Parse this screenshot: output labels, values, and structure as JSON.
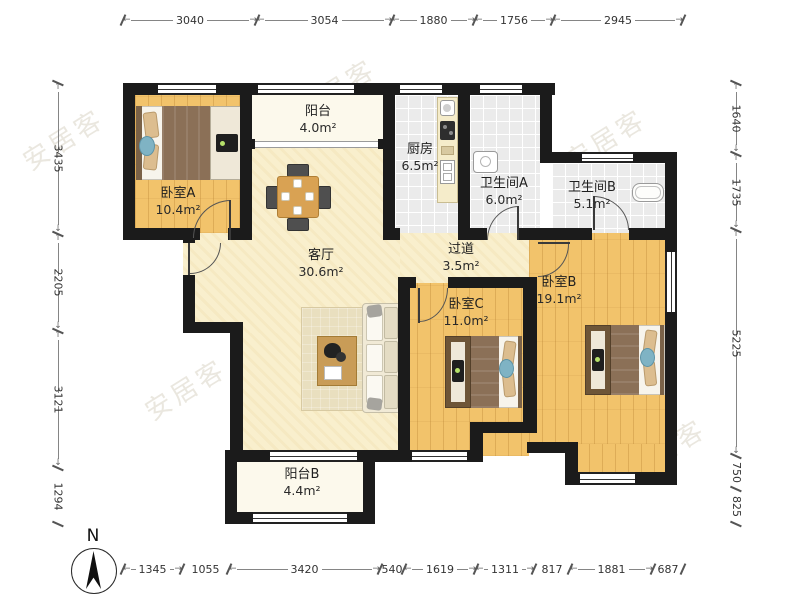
{
  "title": "三室两厅户型图",
  "compass": {
    "label": "N"
  },
  "watermark": {
    "text": "安居客"
  },
  "rooms": [
    {
      "id": "bedroomA",
      "name": "卧室A",
      "area": "10.4m²"
    },
    {
      "id": "balconyA",
      "name": "阳台",
      "area": "4.0m²"
    },
    {
      "id": "kitchen",
      "name": "厨房",
      "area": "6.5m²"
    },
    {
      "id": "bathA",
      "name": "卫生间A",
      "area": "6.0m²"
    },
    {
      "id": "bathB",
      "name": "卫生间B",
      "area": "5.1m²"
    },
    {
      "id": "living",
      "name": "客厅",
      "area": "30.6m²"
    },
    {
      "id": "hallway",
      "name": "过道",
      "area": "3.5m²"
    },
    {
      "id": "bedroomC",
      "name": "卧室C",
      "area": "11.0m²"
    },
    {
      "id": "bedroomB",
      "name": "卧室B",
      "area": "19.1m²"
    },
    {
      "id": "balconyB",
      "name": "阳台B",
      "area": "4.4m²"
    }
  ],
  "dimensions": {
    "top": [
      "3040",
      "3054",
      "1880",
      "1756",
      "2945"
    ],
    "bottom": [
      "1345",
      "1055",
      "3420",
      "540",
      "1619",
      "1311",
      "817",
      "1881",
      "687"
    ],
    "left": [
      "3435",
      "2205",
      "3121",
      "1294"
    ],
    "right": [
      "1640",
      "1735",
      "5225",
      "750",
      "825"
    ]
  }
}
